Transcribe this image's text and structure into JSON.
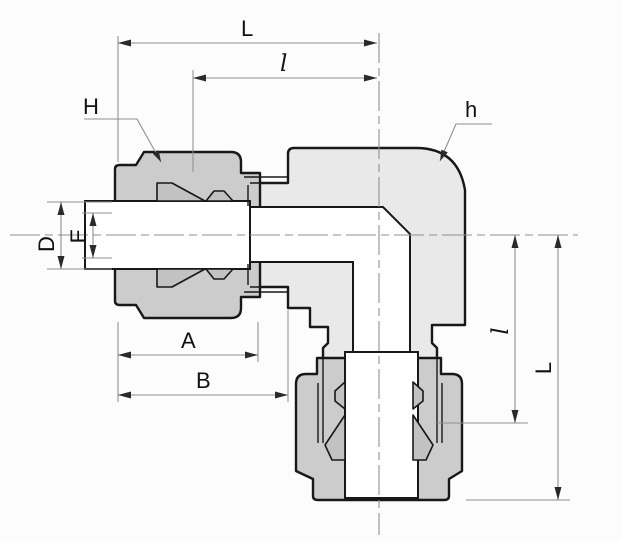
{
  "drawing": {
    "title": "tube-fitting-elbow-cross-section",
    "dim_labels": {
      "L_top": "L",
      "l_top": "l",
      "H": "H",
      "h": "h",
      "D": "D",
      "E": "E",
      "A": "A",
      "B": "B",
      "l_right": "l",
      "L_right": "L"
    }
  },
  "colors": {
    "body": "#e9e9e9",
    "nut": "#cccccc",
    "ferrule": "#c2c2c2",
    "white": "#ffffff",
    "outline": "#181818",
    "dim": "#8f8f8f",
    "arrow": "#2a2a2a",
    "text": "#111111"
  }
}
